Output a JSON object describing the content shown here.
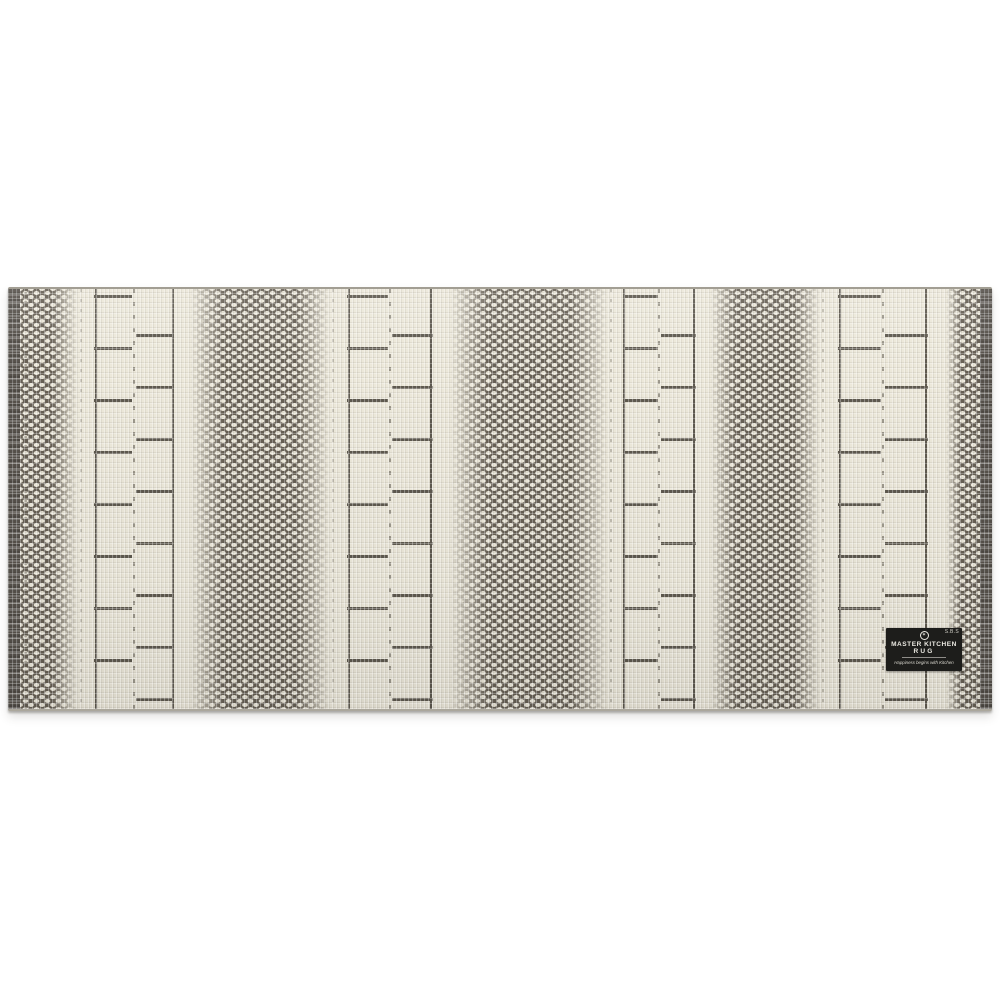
{
  "photo": {
    "description": "Woven kitchen runner rug photographed on a white background; cream fabric with charcoal-gray alternating lattice (honeycomb) stripes and ladder-rung stripes, dark selvedge edges, black brand patch at lower right",
    "background_color": "#ffffff"
  },
  "rug": {
    "colors": {
      "fabric_cream": "#ece8da",
      "pattern_dark": "#5d584e",
      "honeycomb_ground": "#665f54",
      "edge_dark": "#55504a",
      "label_bg": "#1d1d1b",
      "label_text": "#eceae3"
    },
    "stripes": [
      {
        "type": "edge",
        "width": 12
      },
      {
        "type": "honeycomb",
        "width": 58,
        "fade": "right"
      },
      {
        "type": "ladder",
        "width": 112
      },
      {
        "type": "honeycomb",
        "width": 140,
        "fade": "both"
      },
      {
        "type": "ladder",
        "width": 120
      },
      {
        "type": "honeycomb",
        "width": 158,
        "fade": "both"
      },
      {
        "type": "ladder",
        "width": 102
      },
      {
        "type": "honeycomb",
        "width": 110,
        "fade": "both"
      },
      {
        "type": "ladder",
        "width": 126
      },
      {
        "type": "honeycomb",
        "width": 34,
        "fade": "left"
      },
      {
        "type": "edge",
        "width": 12
      }
    ]
  },
  "label": {
    "corner_text": "S.B.S",
    "logo_icon": "circle-emblem",
    "logo_glyph": "✶",
    "brand_line1": "MASTER KITCHEN",
    "brand_line2": "RUG",
    "tagline": "Happiness begins with Kitchen"
  }
}
